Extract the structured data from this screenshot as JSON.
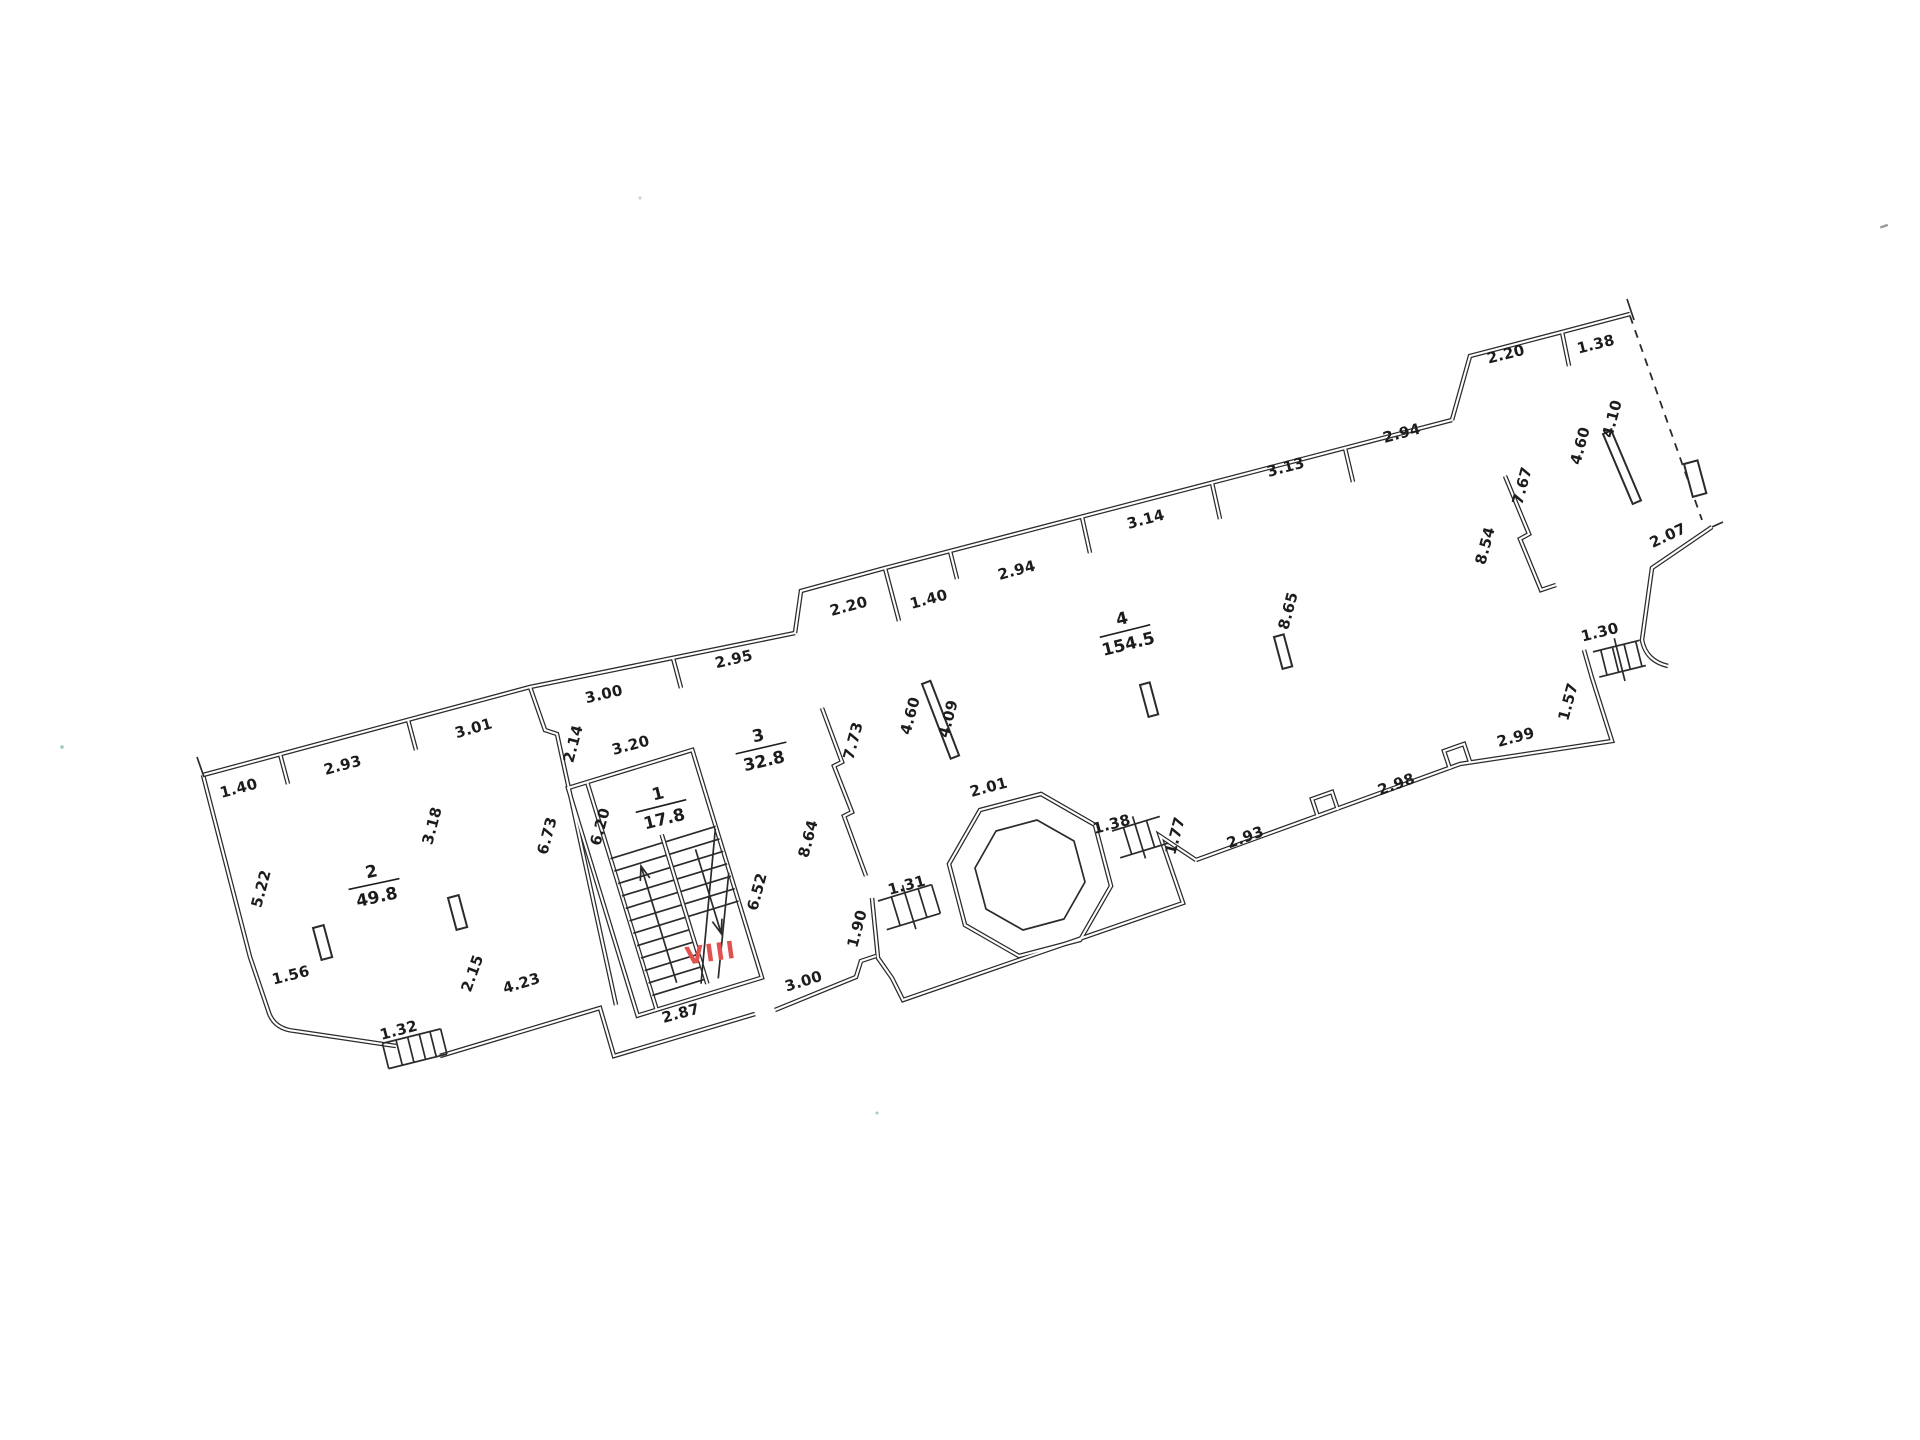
{
  "plan": {
    "type": "floor-plan",
    "line_color": "#2b2b2b",
    "annotation": {
      "text": "VIII",
      "color": "#e0514f",
      "x": 712,
      "y": 961,
      "rot": -8
    },
    "rooms": [
      {
        "number": "2",
        "area": "49.8",
        "x": 374,
        "y": 884,
        "rot": -12
      },
      {
        "number": "1",
        "area": "17.8",
        "x": 661,
        "y": 806,
        "rot": -14
      },
      {
        "number": "3",
        "area": "32.8",
        "x": 761,
        "y": 748,
        "rot": -13
      },
      {
        "number": "4",
        "area": "154.5",
        "x": 1125,
        "y": 631,
        "rot": -14
      }
    ],
    "dimensions": [
      {
        "t": "1.40",
        "x": 240,
        "y": 793,
        "r": -15
      },
      {
        "t": "2.93",
        "x": 344,
        "y": 770,
        "r": -15
      },
      {
        "t": "3.01",
        "x": 475,
        "y": 733,
        "r": -16
      },
      {
        "t": "3.00",
        "x": 605,
        "y": 699,
        "r": -13
      },
      {
        "t": "2.95",
        "x": 735,
        "y": 664,
        "r": -13
      },
      {
        "t": "2.20",
        "x": 850,
        "y": 611,
        "r": -15
      },
      {
        "t": "1.40",
        "x": 930,
        "y": 604,
        "r": -15
      },
      {
        "t": "2.94",
        "x": 1018,
        "y": 575,
        "r": -15
      },
      {
        "t": "3.14",
        "x": 1147,
        "y": 524,
        "r": -15
      },
      {
        "t": "3.13",
        "x": 1287,
        "y": 472,
        "r": -15
      },
      {
        "t": "2.94",
        "x": 1403,
        "y": 438,
        "r": -15
      },
      {
        "t": "2.20",
        "x": 1507,
        "y": 359,
        "r": -14
      },
      {
        "t": "1.38",
        "x": 1597,
        "y": 349,
        "r": -14
      },
      {
        "t": "2.07",
        "x": 1670,
        "y": 540,
        "r": -25
      },
      {
        "t": "1.30",
        "x": 1601,
        "y": 637,
        "r": -14
      },
      {
        "t": "1.57",
        "x": 1573,
        "y": 703,
        "r": -75
      },
      {
        "t": "2.99",
        "x": 1517,
        "y": 742,
        "r": -15
      },
      {
        "t": "2.98",
        "x": 1398,
        "y": 789,
        "r": -20
      },
      {
        "t": "2.93",
        "x": 1247,
        "y": 842,
        "r": -20
      },
      {
        "t": "1.77",
        "x": 1180,
        "y": 837,
        "r": -75
      },
      {
        "t": "1.38",
        "x": 1113,
        "y": 829,
        "r": -15
      },
      {
        "t": "2.01",
        "x": 990,
        "y": 792,
        "r": -15
      },
      {
        "t": "1.31",
        "x": 908,
        "y": 890,
        "r": -15
      },
      {
        "t": "1.90",
        "x": 862,
        "y": 930,
        "r": -75
      },
      {
        "t": "3.00",
        "x": 805,
        "y": 986,
        "r": -17
      },
      {
        "t": "2.87",
        "x": 682,
        "y": 1018,
        "r": -15
      },
      {
        "t": "4.23",
        "x": 523,
        "y": 988,
        "r": -17
      },
      {
        "t": "2.15",
        "x": 477,
        "y": 975,
        "r": -70
      },
      {
        "t": "1.56",
        "x": 292,
        "y": 980,
        "r": -14
      },
      {
        "t": "1.32",
        "x": 400,
        "y": 1035,
        "r": -15
      },
      {
        "t": "3.20",
        "x": 632,
        "y": 750,
        "r": -15
      },
      {
        "t": "5.22",
        "x": 266,
        "y": 890,
        "r": -75
      },
      {
        "t": "3.18",
        "x": 437,
        "y": 827,
        "r": -75
      },
      {
        "t": "2.14",
        "x": 578,
        "y": 745,
        "r": -75
      },
      {
        "t": "6.73",
        "x": 552,
        "y": 837,
        "r": -75
      },
      {
        "t": "6.20",
        "x": 605,
        "y": 828,
        "r": -75
      },
      {
        "t": "6.52",
        "x": 762,
        "y": 893,
        "r": -75
      },
      {
        "t": "8.64",
        "x": 813,
        "y": 840,
        "r": -75
      },
      {
        "t": "7.73",
        "x": 858,
        "y": 742,
        "r": -75
      },
      {
        "t": "4.60",
        "x": 915,
        "y": 717,
        "r": -75
      },
      {
        "t": "4.09",
        "x": 953,
        "y": 720,
        "r": -75
      },
      {
        "t": "8.65",
        "x": 1293,
        "y": 612,
        "r": -75
      },
      {
        "t": "8.54",
        "x": 1490,
        "y": 547,
        "r": -75
      },
      {
        "t": "7.67",
        "x": 1527,
        "y": 487,
        "r": -75
      },
      {
        "t": "4.60",
        "x": 1585,
        "y": 447,
        "r": -75
      },
      {
        "t": "4.10",
        "x": 1617,
        "y": 420,
        "r": -75
      }
    ]
  }
}
